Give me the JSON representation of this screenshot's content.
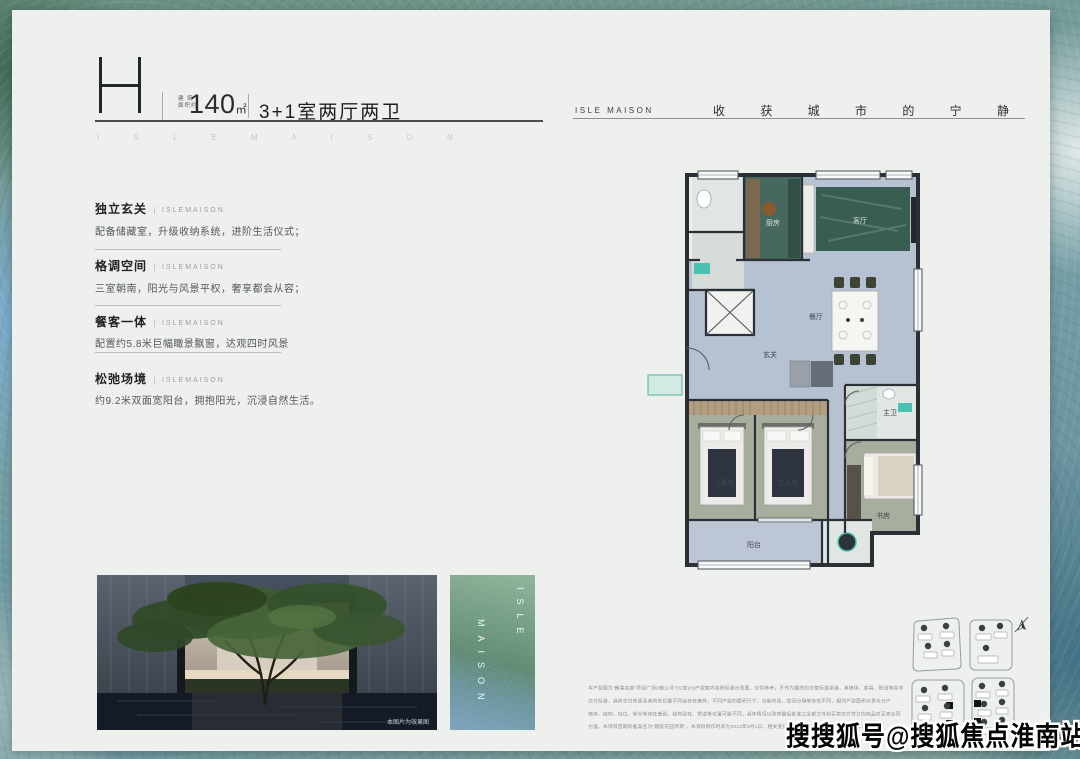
{
  "palette": {
    "card_bg": "#edf0ec",
    "accent_teal": "#49c2b1",
    "plan_wall": "#2b3036",
    "plan_floor": "#b6c1d2",
    "plan_marble": "#3a5d52",
    "text_dark": "#222222",
    "text_gray": "#8d8f8c",
    "watermark_color": "#050505"
  },
  "header": {
    "plan_letter": "H",
    "area_label_line1": "建 筑",
    "area_label_line2": "面积约",
    "area_value": "140",
    "area_unit": "㎡",
    "layout_text": "3+1室两厅两卫",
    "brand_spaced": "ISLEMAISON"
  },
  "tagline": {
    "brand": "ISLE MAISON",
    "slogan": "收获城市的宁静"
  },
  "features": [
    {
      "title": "独立玄关",
      "brand": "ISLEMAISON",
      "desc": "配备储藏室，升级收纳系统，进阶生活仪式；"
    },
    {
      "title": "格调空间",
      "brand": "ISLEMAISON",
      "desc": "三室朝南，阳光与风景平权，奢享都会从容；"
    },
    {
      "title": "餐客一体",
      "brand": "ISLEMAISON",
      "desc": "配置约5.8米巨幅瞰景飘窗，达观四时风景"
    },
    {
      "title": "松弛场境",
      "brand": "ISLEMAISON",
      "desc": "约9.2米双面宽阳台，拥抱阳光，沉浸自然生活。"
    }
  ],
  "floorplan": {
    "labels": {
      "living": "客厅",
      "dining": "餐厅",
      "kitchen": "厨房",
      "entry": "玄关",
      "kids_room": "儿童房",
      "master_room": "主人房",
      "study": "书房",
      "balcony": "阳台",
      "bath": "主卫"
    }
  },
  "photos": {
    "render_caption": "本图片为效果图",
    "glass_col_right": "ISLE",
    "glass_col_left": "MAISON"
  },
  "disclaimer": {
    "lines": [
      "本户型图为“朗玺名庭”项目广场2幢11号702室(H)户型室内装修标准示意图，仅供参考，不作为最终的交楼标准承诺，其墙体、家具、陈设等并非",
      "交付标准，具体交付资源及其所在位置不同会存在差异，不同户型的面积尺寸、功能布局、空间分隔等存在不同，相邻户型面积示意与分户",
      "墙体、结构、柱位、采光等存在差别，结构梁柱、管道等位置可能不同，具体情况以政府最后批准之全部文件和买卖双方签订的商品房买卖合同",
      "为准。本项目首期的备案名为“朗玺花园项目”，本资料制作时间为2023年9月1日，相关变化不再另行通知，敬请参阅最新发布资讯。"
    ]
  },
  "watermark": "搜搜狐号@搜狐焦点淮南站"
}
